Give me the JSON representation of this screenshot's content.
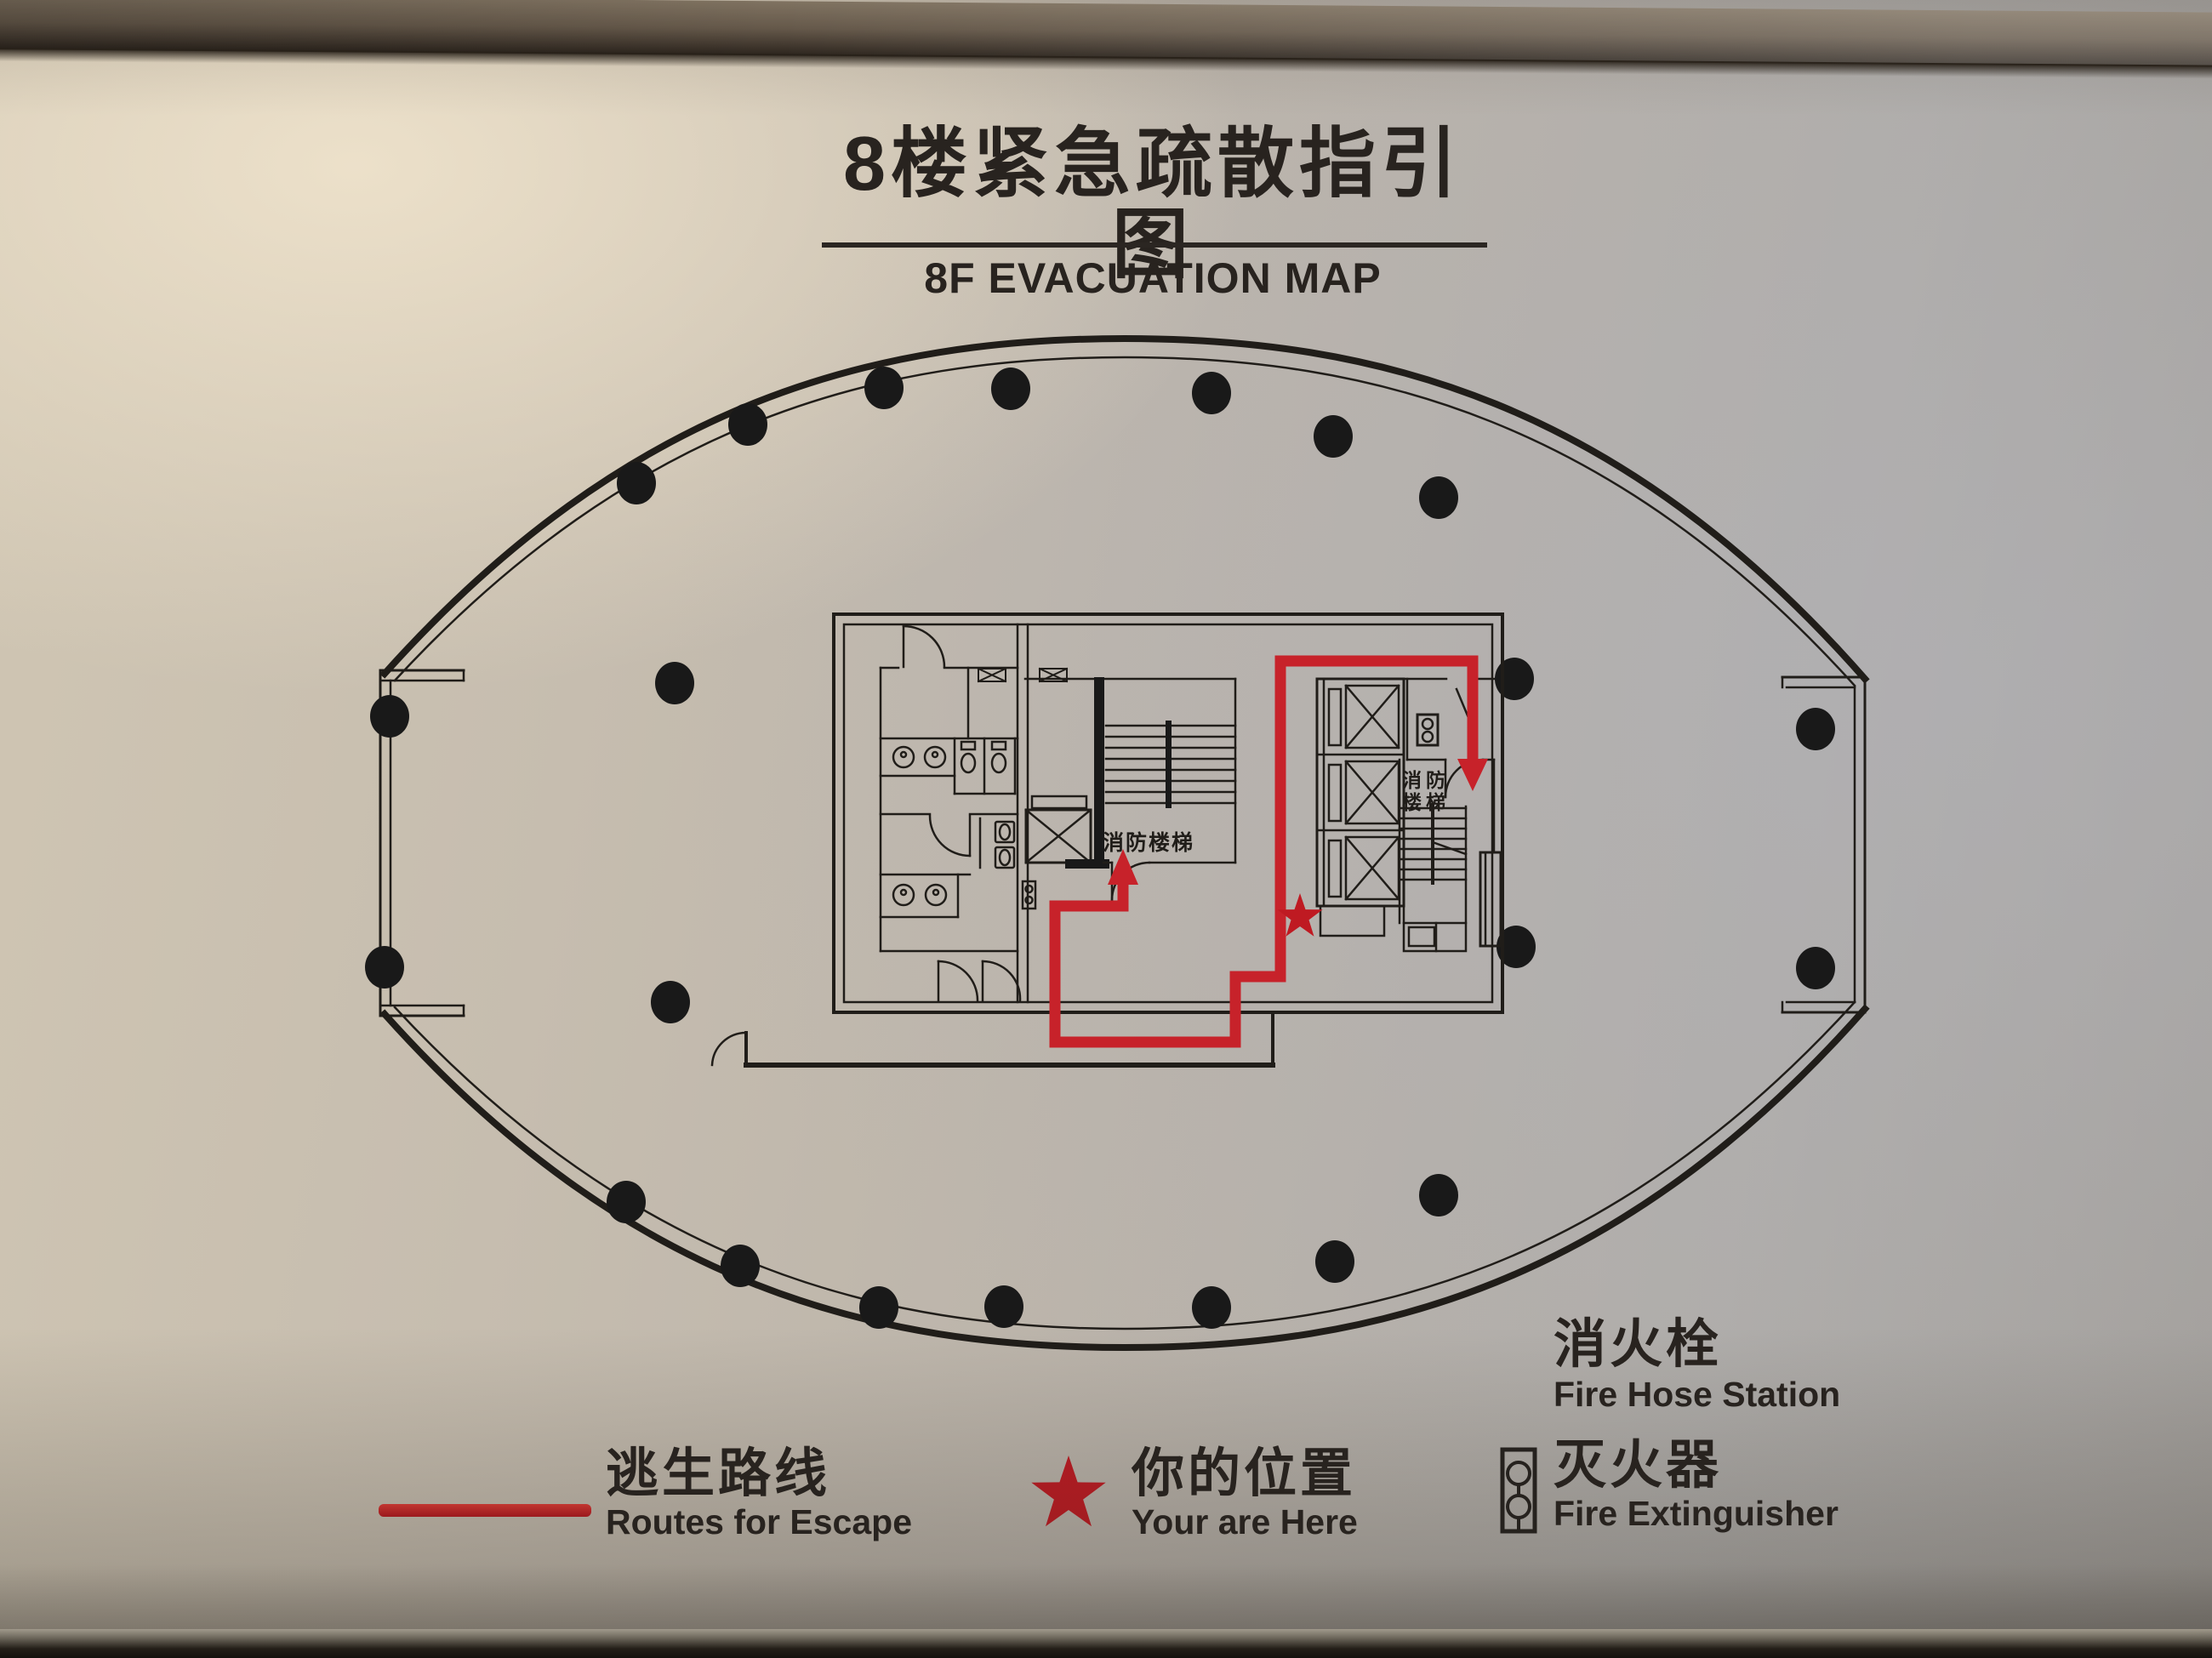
{
  "sign": {
    "title_zh": "8楼紧急疏散指引图",
    "title_en": "8F EVACUATION MAP"
  },
  "plan": {
    "stair_label_left": "消防楼梯",
    "stair_label_right_top": "消防",
    "stair_label_right_bottom": "楼梯"
  },
  "legend": {
    "route_zh": "逃生路线",
    "route_en": "Routes for Escape",
    "location_zh": "你的位置",
    "location_en": "Your are Here",
    "hose_zh": "消火栓",
    "hose_en": "Fire Hose Station",
    "extinguisher_zh": "灭火器",
    "extinguisher_en": "Fire Extinguisher"
  },
  "colors": {
    "route_red": "#c7222a",
    "star_red": "#bf1a22",
    "ink": "#201d19"
  }
}
